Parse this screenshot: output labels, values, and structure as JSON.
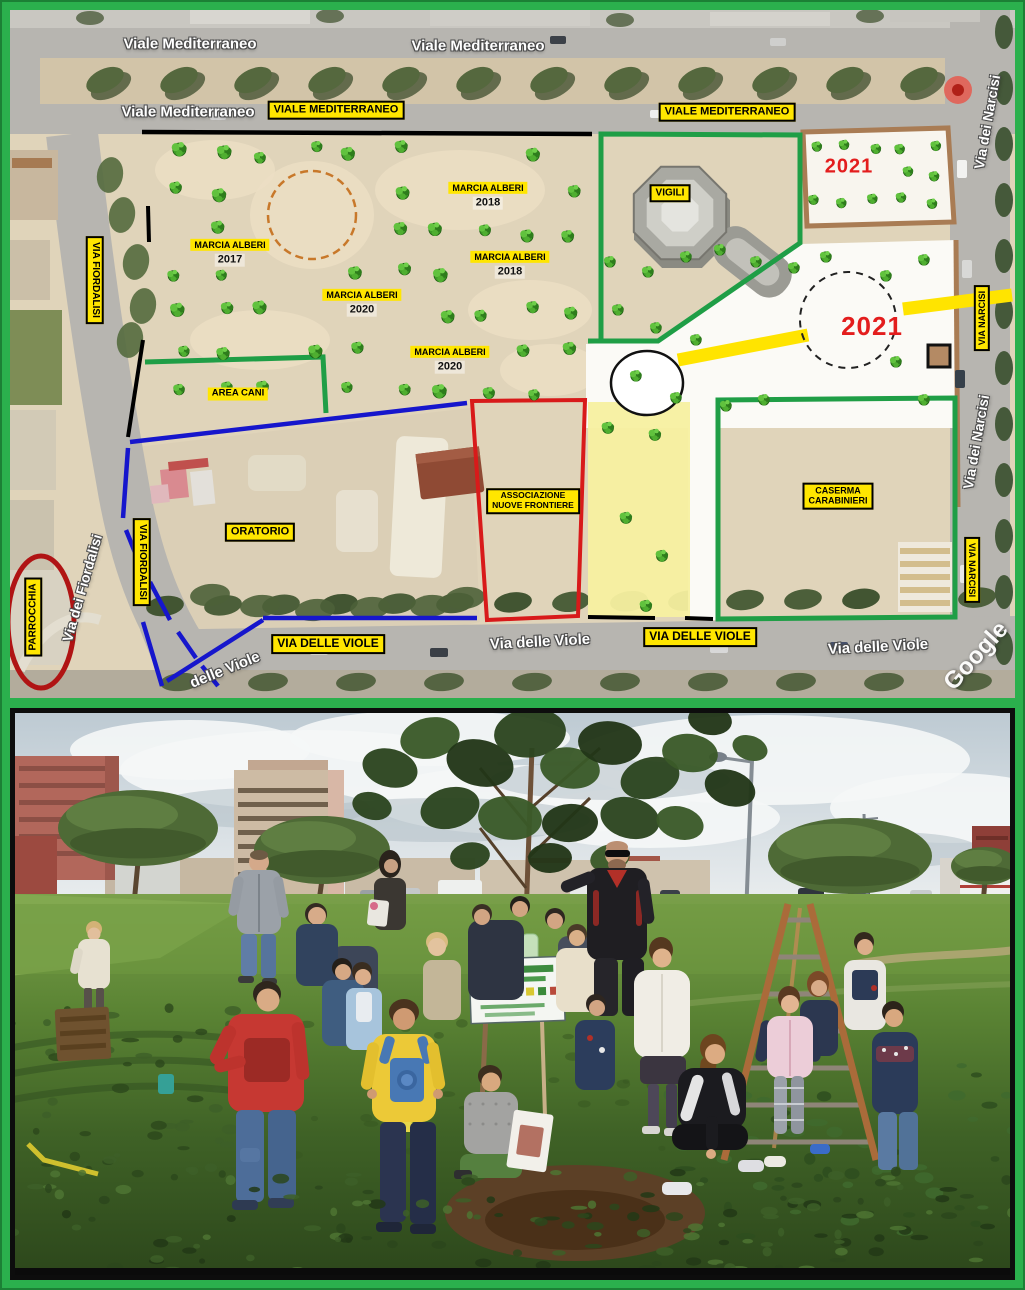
{
  "map": {
    "streets": {
      "viale_mediterraneo": "Viale Mediterraneo",
      "via_dei_narcisi": "Via dei Narcisi",
      "via_dei_fiordalisi": "Via dei Fiordalisi",
      "via_delle_viole": "Via delle Viole",
      "delle_viole": "delle Viole"
    },
    "signs": {
      "viale_mediterraneo": "VIALE MEDITERRANEO",
      "via_fiordalisi": "VIA FIORDALISI",
      "via_narcisi": "VIA NARCISI",
      "via_delle_viole": "VIA DELLE VIOLE",
      "vigili": "VIGILI",
      "area_cani": "AREA CANI",
      "oratorio": "ORATORIO",
      "associazione_line1": "ASSOCIAZIONE",
      "associazione_line2": "NUOVE FRONTIERE",
      "caserma_line1": "CASERMA",
      "caserma_line2": "CARABINIERI",
      "parrocchia": "PARROCCHIA",
      "marcia_alberi": "MARCIA ALBERI"
    },
    "years": {
      "y2017": "2017",
      "y2018": "2018",
      "y2020": "2020",
      "y2021": "2021"
    },
    "watermark": "Google"
  },
  "colors": {
    "frame_green": "#2bb04d",
    "label_yellow": "#ffe600",
    "year_red": "#e31d1d",
    "line_blue": "#1616cc",
    "line_red": "#d81a1a",
    "line_green": "#1f9e46",
    "line_black": "#000000",
    "path_yellow": "#ffe400",
    "border_brown": "#a97c54"
  }
}
